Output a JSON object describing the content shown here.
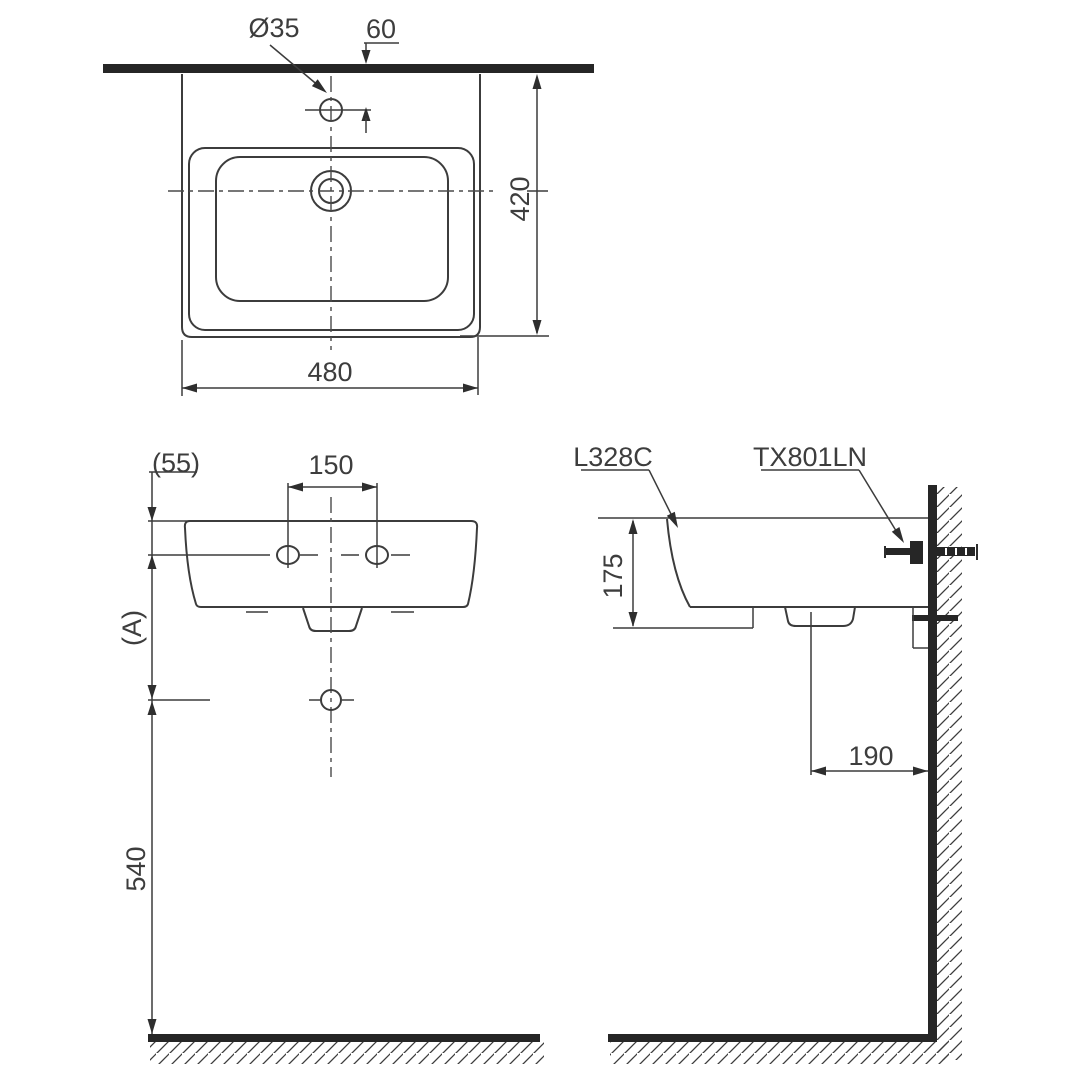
{
  "drawing": {
    "top_view": {
      "hole_dia": "Ø35",
      "hole_offset": "60",
      "depth": "420",
      "width": "480"
    },
    "front_view": {
      "rim_to_hole": "(55)",
      "hole_spacing": "150",
      "hole_to_drain": "(A)",
      "drain_height": "540"
    },
    "side_view": {
      "lavatory_model": "L328C",
      "fitting_model": "TX801LN",
      "front_depth": "175",
      "drain_offset": "190"
    },
    "colors": {
      "line": "#3c3c3c",
      "solid": "#262626",
      "background": "#ffffff"
    }
  }
}
